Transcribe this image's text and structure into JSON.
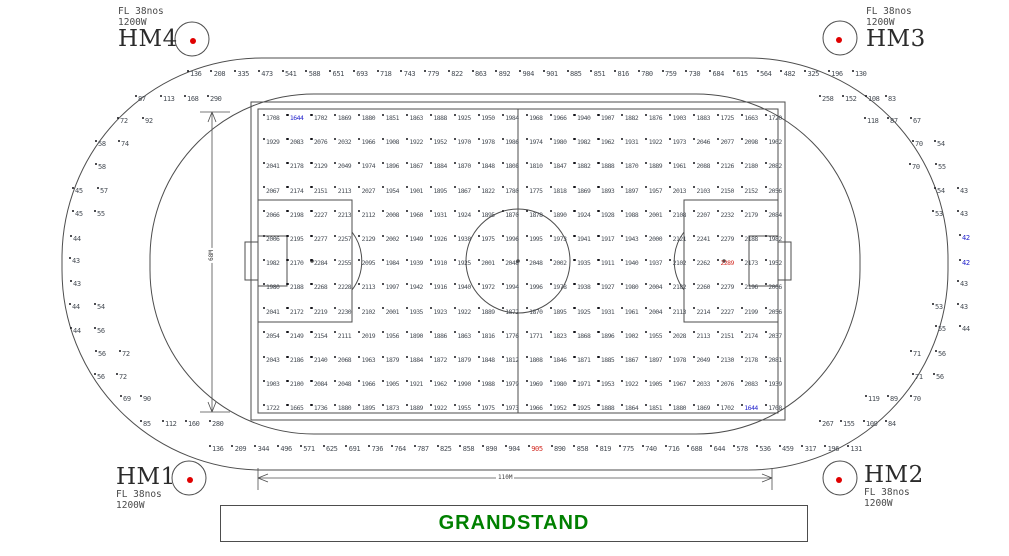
{
  "masts": {
    "hm4": {
      "name": "HM4",
      "spec1": "FL 38nos",
      "spec2": "1200W"
    },
    "hm3": {
      "name": "HM3",
      "spec1": "FL 38nos",
      "spec2": "1200W"
    },
    "hm1": {
      "name": "HM1",
      "spec1": "FL 38nos",
      "spec2": "1200W"
    },
    "hm2": {
      "name": "HM2",
      "spec1": "FL 38nos",
      "spec2": "1200W"
    }
  },
  "grandstand": {
    "label": "GRANDSTAND"
  },
  "dimensions": {
    "length": "110M",
    "width": "68M"
  },
  "colors": {
    "min_value": "#2323cc",
    "max_value": "#d22a22",
    "value_text": "#474d55",
    "grandstand_text": "#008000",
    "mast_dot": "#e00000",
    "line": "#4d4d4d"
  },
  "illuminance": {
    "pitch_min_value": 1644,
    "pitch_max_value": 2289,
    "min_cells": [
      [
        0,
        1
      ],
      [
        12,
        20
      ]
    ],
    "max_cell": [
      6,
      19
    ],
    "pitch_rows": [
      [
        1708,
        1644,
        1702,
        1869,
        1880,
        1851,
        1863,
        1888,
        1925,
        1950,
        1984,
        1968,
        1966,
        1940,
        1907,
        1882,
        1876,
        1903,
        1883,
        1725,
        1663,
        1720
      ],
      [
        1929,
        2083,
        2076,
        2032,
        1966,
        1908,
        1922,
        1952,
        1970,
        1978,
        1986,
        1974,
        1980,
        1982,
        1962,
        1931,
        1922,
        1973,
        2046,
        2077,
        2098,
        1902
      ],
      [
        2041,
        2178,
        2129,
        2049,
        1974,
        1896,
        1867,
        1884,
        1870,
        1848,
        1808,
        1810,
        1847,
        1882,
        1888,
        1870,
        1889,
        1961,
        2088,
        2126,
        2180,
        2082
      ],
      [
        2067,
        2174,
        2151,
        2113,
        2027,
        1954,
        1901,
        1895,
        1867,
        1822,
        1780,
        1775,
        1818,
        1869,
        1893,
        1897,
        1957,
        2013,
        2103,
        2150,
        2152,
        2056
      ],
      [
        2066,
        2198,
        2227,
        2213,
        2112,
        2008,
        1960,
        1931,
        1924,
        1895,
        1870,
        1878,
        1890,
        1924,
        1928,
        1988,
        2001,
        2108,
        2207,
        2232,
        2179,
        2084
      ],
      [
        2006,
        2195,
        2277,
        2257,
        2129,
        2002,
        1949,
        1926,
        1938,
        1975,
        1996,
        1995,
        1973,
        1941,
        1917,
        1943,
        2000,
        2121,
        2241,
        2279,
        2188,
        1982
      ],
      [
        1982,
        2170,
        2284,
        2255,
        2095,
        1984,
        1939,
        1910,
        1925,
        2001,
        2048,
        2048,
        2002,
        1935,
        1911,
        1940,
        1937,
        2102,
        2262,
        2289,
        2173,
        1952
      ],
      [
        1980,
        2188,
        2268,
        2228,
        2113,
        1997,
        1942,
        1916,
        1940,
        1972,
        1994,
        1996,
        1978,
        1938,
        1927,
        1980,
        2004,
        2182,
        2260,
        2279,
        2196,
        2006
      ],
      [
        2041,
        2172,
        2219,
        2230,
        2102,
        2001,
        1935,
        1923,
        1922,
        1889,
        1872,
        1870,
        1895,
        1925,
        1931,
        1961,
        2004,
        2113,
        2214,
        2227,
        2199,
        2056
      ],
      [
        2054,
        2149,
        2154,
        2111,
        2019,
        1956,
        1890,
        1886,
        1863,
        1816,
        1776,
        1771,
        1823,
        1868,
        1896,
        1902,
        1955,
        2028,
        2113,
        2151,
        2174,
        2037
      ],
      [
        2043,
        2186,
        2140,
        2068,
        1963,
        1879,
        1884,
        1872,
        1879,
        1848,
        1812,
        1808,
        1846,
        1871,
        1885,
        1867,
        1897,
        1978,
        2049,
        2130,
        2178,
        2081
      ],
      [
        1903,
        2100,
        2084,
        2048,
        1966,
        1905,
        1921,
        1962,
        1990,
        1988,
        1979,
        1969,
        1980,
        1971,
        1953,
        1922,
        1905,
        1967,
        2033,
        2076,
        2083,
        1939
      ],
      [
        1722,
        1665,
        1736,
        1880,
        1895,
        1873,
        1889,
        1922,
        1955,
        1975,
        1973,
        1966,
        1952,
        1925,
        1888,
        1864,
        1851,
        1880,
        1869,
        1702,
        1644,
        1708
      ]
    ],
    "track_top_row": [
      136,
      208,
      335,
      473,
      541,
      588,
      651,
      693,
      718,
      743,
      779,
      822,
      863,
      892,
      904,
      901,
      885,
      851,
      816,
      780,
      759,
      730,
      684,
      615,
      564,
      482,
      325,
      196,
      130
    ],
    "track_top_left2": [
      87,
      113,
      168,
      290
    ],
    "track_top_right2": [
      258,
      152,
      108,
      83
    ],
    "track_bottom_row": [
      136,
      209,
      344,
      496,
      571,
      625,
      691,
      736,
      764,
      787,
      825,
      858,
      890,
      904,
      905,
      890,
      858,
      819,
      775,
      740,
      716,
      688,
      644,
      578,
      536,
      459,
      317,
      196,
      131
    ],
    "bottom_red_index": 14,
    "track_bottom_left2": [
      85,
      112,
      160,
      280
    ],
    "track_bottom_right2": [
      267,
      155,
      109,
      84
    ],
    "left_side": [
      {
        "x": 120,
        "y": 118,
        "v": "72"
      },
      {
        "x": 145,
        "y": 118,
        "v": "92"
      },
      {
        "x": 98,
        "y": 141,
        "v": "58"
      },
      {
        "x": 121,
        "y": 141,
        "v": "74"
      },
      {
        "x": 98,
        "y": 164,
        "v": "58"
      },
      {
        "x": 75,
        "y": 188,
        "v": "45"
      },
      {
        "x": 100,
        "y": 188,
        "v": "57"
      },
      {
        "x": 75,
        "y": 211,
        "v": "45"
      },
      {
        "x": 97,
        "y": 211,
        "v": "55"
      },
      {
        "x": 73,
        "y": 236,
        "v": "44"
      },
      {
        "x": 72,
        "y": 258,
        "v": "43"
      },
      {
        "x": 73,
        "y": 281,
        "v": "43"
      },
      {
        "x": 72,
        "y": 304,
        "v": "44"
      },
      {
        "x": 97,
        "y": 304,
        "v": "54"
      },
      {
        "x": 73,
        "y": 328,
        "v": "44"
      },
      {
        "x": 97,
        "y": 328,
        "v": "56"
      },
      {
        "x": 98,
        "y": 351,
        "v": "56"
      },
      {
        "x": 122,
        "y": 351,
        "v": "72"
      },
      {
        "x": 97,
        "y": 374,
        "v": "56"
      },
      {
        "x": 119,
        "y": 374,
        "v": "72"
      },
      {
        "x": 123,
        "y": 396,
        "v": "69"
      },
      {
        "x": 143,
        "y": 396,
        "v": "90"
      }
    ],
    "right_side": [
      {
        "x": 867,
        "y": 118,
        "v": "118"
      },
      {
        "x": 890,
        "y": 118,
        "v": "87"
      },
      {
        "x": 913,
        "y": 118,
        "v": "67"
      },
      {
        "x": 915,
        "y": 141,
        "v": "70"
      },
      {
        "x": 937,
        "y": 141,
        "v": "54"
      },
      {
        "x": 912,
        "y": 164,
        "v": "70"
      },
      {
        "x": 938,
        "y": 164,
        "v": "55"
      },
      {
        "x": 937,
        "y": 188,
        "v": "54"
      },
      {
        "x": 960,
        "y": 188,
        "v": "43"
      },
      {
        "x": 935,
        "y": 211,
        "v": "53"
      },
      {
        "x": 960,
        "y": 211,
        "v": "43"
      },
      {
        "x": 962,
        "y": 235,
        "v": "42",
        "c": "min"
      },
      {
        "x": 962,
        "y": 260,
        "v": "42",
        "c": "min"
      },
      {
        "x": 960,
        "y": 281,
        "v": "43"
      },
      {
        "x": 935,
        "y": 304,
        "v": "53"
      },
      {
        "x": 960,
        "y": 304,
        "v": "43"
      },
      {
        "x": 938,
        "y": 326,
        "v": "55"
      },
      {
        "x": 962,
        "y": 326,
        "v": "44"
      },
      {
        "x": 913,
        "y": 351,
        "v": "71"
      },
      {
        "x": 938,
        "y": 351,
        "v": "56"
      },
      {
        "x": 915,
        "y": 374,
        "v": "71"
      },
      {
        "x": 936,
        "y": 374,
        "v": "56"
      },
      {
        "x": 868,
        "y": 396,
        "v": "119"
      },
      {
        "x": 890,
        "y": 396,
        "v": "89"
      },
      {
        "x": 913,
        "y": 396,
        "v": "70"
      }
    ]
  }
}
